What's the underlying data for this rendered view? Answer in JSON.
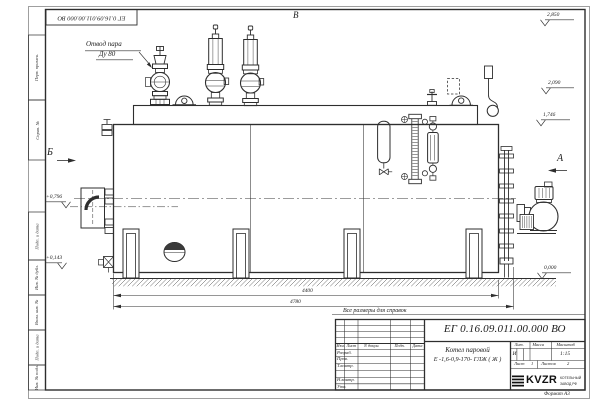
{
  "title_block": {
    "doc_number": "ЕГ 0.16.09.011.00.000  ВО",
    "product_line1": "Котел паровой",
    "product_line2": "Е -1,6-0,9-170- ГЛЖ ( Ж )",
    "headers": {
      "lit": "Лит.",
      "mass": "Масса",
      "scale": "Масштаб"
    },
    "lit_value": "И",
    "scale_value": "1:15",
    "sheet": {
      "label": "Лист",
      "value": "1"
    },
    "sheets": {
      "label": "Листов",
      "value": "2"
    },
    "columns": [
      "Изм.",
      "Лист",
      "N докум.",
      "Подп.",
      "Дата"
    ],
    "signature_rows": [
      "Разраб.",
      "Пров.",
      "Т.контр.",
      "Н.контр.",
      "Утв."
    ],
    "logo": {
      "text": "KVZR",
      "caption1": "КОТЕЛЬНЫЙ",
      "caption2": "ЗАВОД РФ"
    },
    "format": "Формат А3"
  },
  "annotations": {
    "callout_line1": "Отвод пара",
    "callout_line2": "Ду 80",
    "note": "Все размеры для справок",
    "view_a": "А",
    "view_b": "Б",
    "view_v": "В",
    "dim_length_body": "4400",
    "dim_length_overall": "4780",
    "elev_2850": "2,850",
    "elev_2090": "2,090",
    "elev_1746": "1,746",
    "elev_0796": "+0,796",
    "elev_0143": "+0,143",
    "elev_0000": "0,000"
  },
  "margin_stamps": [
    "Перв. примен.",
    "Справ. №",
    "Подп. и дата",
    "Инв. № дубл.",
    "Взам. инв. №",
    "Подп. и дата",
    "Инв. № подл."
  ],
  "colors": {
    "line": "#2e2e2e",
    "paper": "#ffffff"
  }
}
